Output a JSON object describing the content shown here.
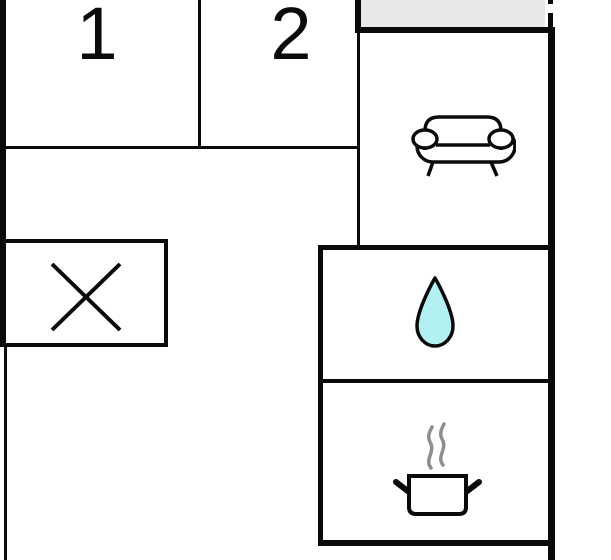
{
  "plan": {
    "type": "apartment-floor-plan",
    "rooms": [
      {
        "id": "room-1",
        "label": "1"
      },
      {
        "id": "room-2",
        "label": "2"
      },
      {
        "id": "living-area",
        "label": "",
        "icon": "sofa-icon"
      },
      {
        "id": "bathroom",
        "label": "",
        "icon": "water-drop-icon"
      },
      {
        "id": "kitchen",
        "label": "",
        "icon": "cooking-pot-icon"
      },
      {
        "id": "crossed-area",
        "label": "",
        "icon": "cross-icon"
      },
      {
        "id": "balcony",
        "label": "",
        "icon": ""
      }
    ],
    "colors": {
      "wall": "#0a0a0a",
      "balcony-fill": "#e8e8e8",
      "drop-fill": "#b3f0f1",
      "steam": "#8e8e8e",
      "background": "#ffffff"
    }
  }
}
